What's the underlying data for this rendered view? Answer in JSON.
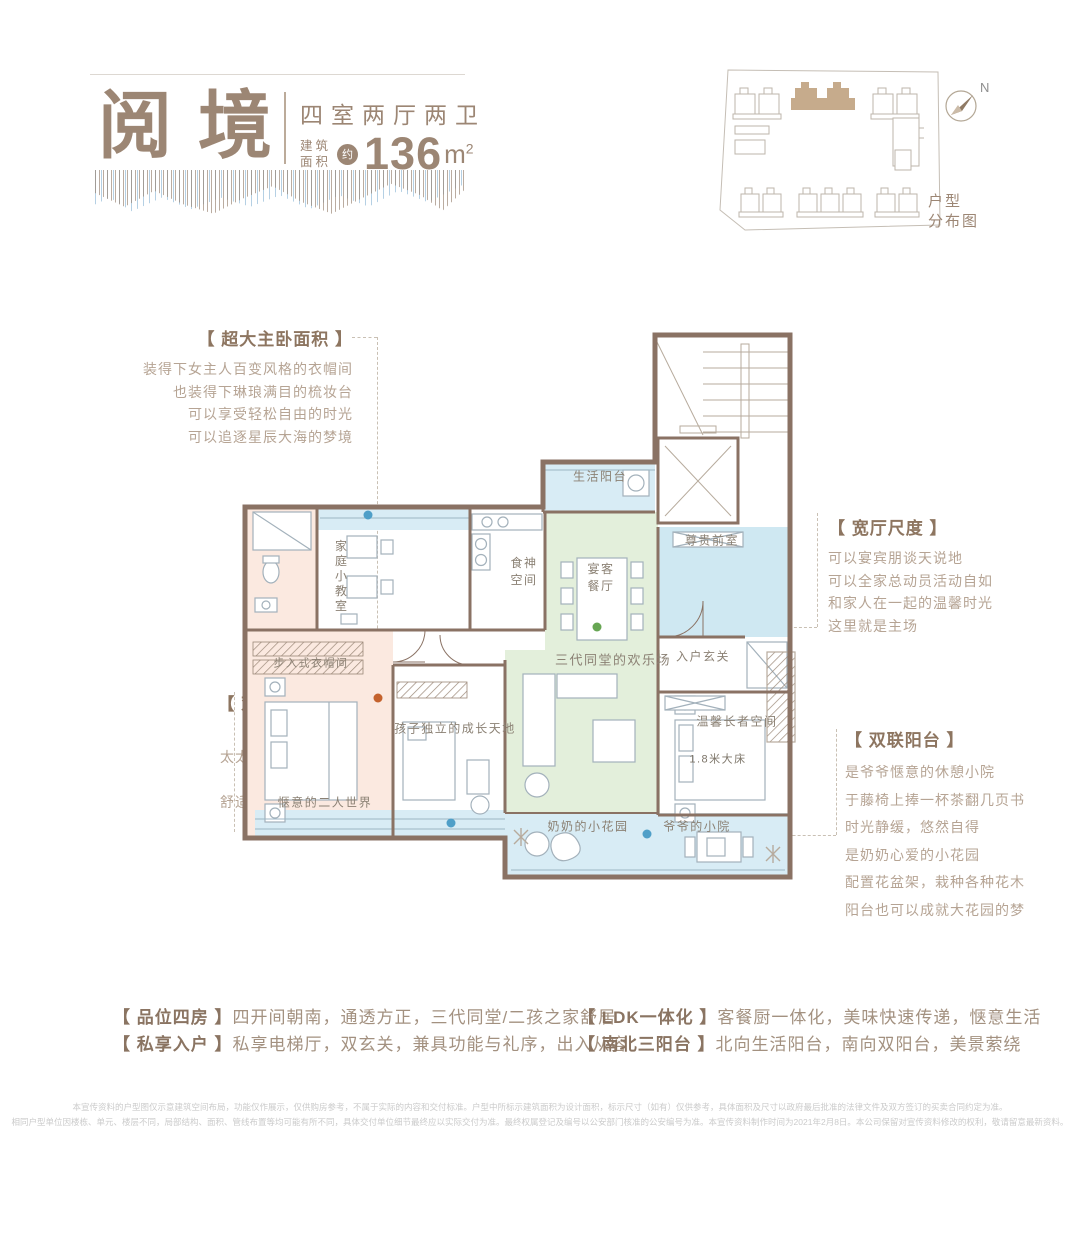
{
  "colors": {
    "brand": "#9c8674",
    "brand_dark": "#8a7462",
    "text_light": "#b6a494",
    "wall": "#8a7264",
    "fill_pink": "#fbe9e0",
    "fill_green": "#e3efdb",
    "fill_blue": "#cfe8f2",
    "fill_lightblue": "#d8ecf5",
    "dot_blue": "#4f9fc8",
    "dot_orange": "#c4622d",
    "dot_green": "#67a653"
  },
  "header": {
    "title": "阅境",
    "subtitle": "四室两厅两卫",
    "area_prefix_top": "建筑",
    "area_prefix_bottom": "面积",
    "area_approx": "约",
    "area_value": "136",
    "area_unit": "m",
    "area_sup": "2"
  },
  "siteplan": {
    "north": "N",
    "caption": "户型\n分布图"
  },
  "annotations": [
    {
      "title": "【 超大主卧面积 】",
      "lines": [
        "装得下女主人百变风格的衣帽间",
        "也装得下琳琅满目的梳妆台",
        "可以享受轻松自由的时光",
        "可以追逐星辰大海的梦境"
      ]
    },
    {
      "title": "【 观景四飘窗 】",
      "lines": [
        "孩子的观星台",
        "太太的阳光SPA空间",
        "清风萦绕",
        "舒适主义与浪漫主义",
        "完美邂逅"
      ]
    },
    {
      "title": "【 宽厅尺度 】",
      "lines": [
        "可以宴宾朋谈天说地",
        "可以全家总动员活动自如",
        "和家人在一起的温馨时光",
        "这里就是主场"
      ]
    },
    {
      "title": "【 双联阳台 】",
      "lines": [
        "是爷爷惬意的休憩小院",
        "于藤椅上捧一杯茶翻几页书",
        "时光静缓，悠然自得",
        "是奶奶心爱的小花园",
        "配置花盆架，栽种各种花木",
        "阳台也可以成就大花园的梦"
      ]
    }
  ],
  "plan": {
    "rooms": {
      "life_balcony": "生活阳台",
      "front_room": "尊贵前室",
      "dining": "宴客\n餐厅",
      "kitchen": "食神\n空间",
      "foyer": "入户玄关",
      "living": "三代同堂的欢乐场",
      "classroom": "家庭小教室",
      "closet": "步入式衣帽间",
      "master": "惬意的二人世界",
      "kids": "孩子独立的成长天地",
      "elder": "温馨长者空间",
      "elder_bed": "1.8米大床",
      "grandma_garden": "奶奶的小花园",
      "grandpa_yard": "爷爷的小院"
    }
  },
  "features": [
    {
      "title": "【 品位四房 】",
      "desc": "四开间朝南，通透方正，三代同堂/二孩之家舒居"
    },
    {
      "title": "【 私享入户 】",
      "desc": "私享电梯厅，双玄关，兼具功能与礼序，出入从容"
    },
    {
      "title": "【 LDK一体化 】",
      "desc": "客餐厨一体化，美味快速传递，惬意生活"
    },
    {
      "title": "【 南北三阳台 】",
      "desc": "北向生活阳台，南向双阳台，美景萦绕"
    }
  ],
  "disclaimer": {
    "line1": "本宣传资料的户型图仅示意建筑空间布局，功能仅作展示，仅供购房参考，不属于实际的内容和交付标准。户型中所标示建筑面积为设计面积，标示尺寸（如有）仅供参考，具体面积及尺寸以政府最后批准的法律文件及双方签订的买卖合同约定为准。",
    "line2": "相同户型单位因楼栋、单元、楼层不同，局部结构、面积、管线布置等均可能有所不同，具体交付单位细节最终应以实际交付为准。最终权属登记及编号以公安部门核准的公安编号为准。本宣传资料制作时间为2021年2月8日。本公司保留对宣传资料修改的权利，敬请留意最新资料。"
  }
}
